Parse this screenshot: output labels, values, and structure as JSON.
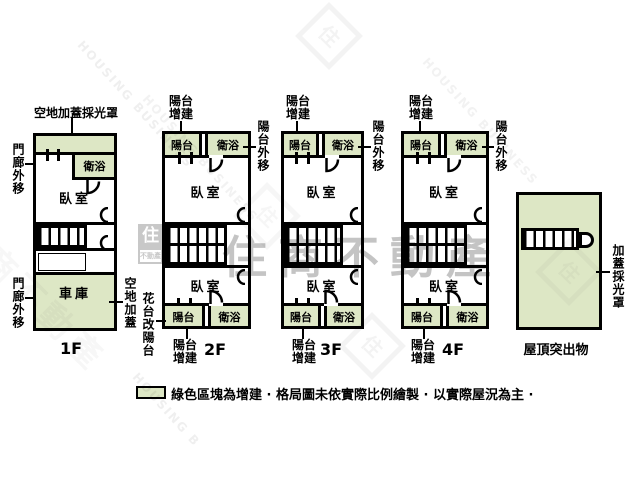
{
  "colors": {
    "addition_green": "#dde7c5",
    "wall": "#000000",
    "watermark_gray": "#8a8a8a"
  },
  "legend": {
    "text": "綠色區塊為增建 · 格局圖未依實際比例繪製 · 以實際屋況為主 ·"
  },
  "watermark": {
    "brand": "住商不動產",
    "brand_en": "HOUSING BUSINESS",
    "brand_en_short": "HOUSING B",
    "logo_top": "住",
    "logo_bottom": "不動產",
    "stamp_char": "住"
  },
  "f1": {
    "name": "1F",
    "top_label": "空地加蓋採光罩",
    "porch_upper": "門廊外移",
    "porch_lower": "門廊外移",
    "open_air": "空地加蓋",
    "bath": "衛浴",
    "bedroom": "臥室",
    "garage": "車庫"
  },
  "f2": {
    "name": "2F",
    "balcony_add_top": "陽台增建",
    "balcony_top": "陽台",
    "bath_top": "衛浴",
    "balcony_out": "陽台外移",
    "bedroom_front": "臥室",
    "bedroom_back": "臥室",
    "balcony_bottom": "陽台",
    "bath_bottom": "衛浴",
    "balcony_add_bottom": "陽台增建",
    "flowerbed": "花台改陽台"
  },
  "f3": {
    "name": "3F",
    "balcony_add_top": "陽台增建",
    "balcony_top": "陽台",
    "bath_top": "衛浴",
    "balcony_out": "陽台外移",
    "bedroom_front": "臥室",
    "bedroom_back": "臥室",
    "balcony_bottom": "陽台",
    "bath_bottom": "衛浴",
    "balcony_add_bottom": "陽台增建"
  },
  "f4": {
    "name": "4F",
    "balcony_add_top": "陽台增建",
    "balcony_top": "陽台",
    "bath_top": "衛浴",
    "balcony_out": "陽台外移",
    "bedroom_front": "臥室",
    "bedroom_back": "臥室",
    "balcony_bottom": "陽台",
    "bath_bottom": "衛浴",
    "balcony_add_bottom": "陽台增建"
  },
  "roof": {
    "name": "屋頂突出物",
    "skylight": "加蓋採光罩"
  }
}
